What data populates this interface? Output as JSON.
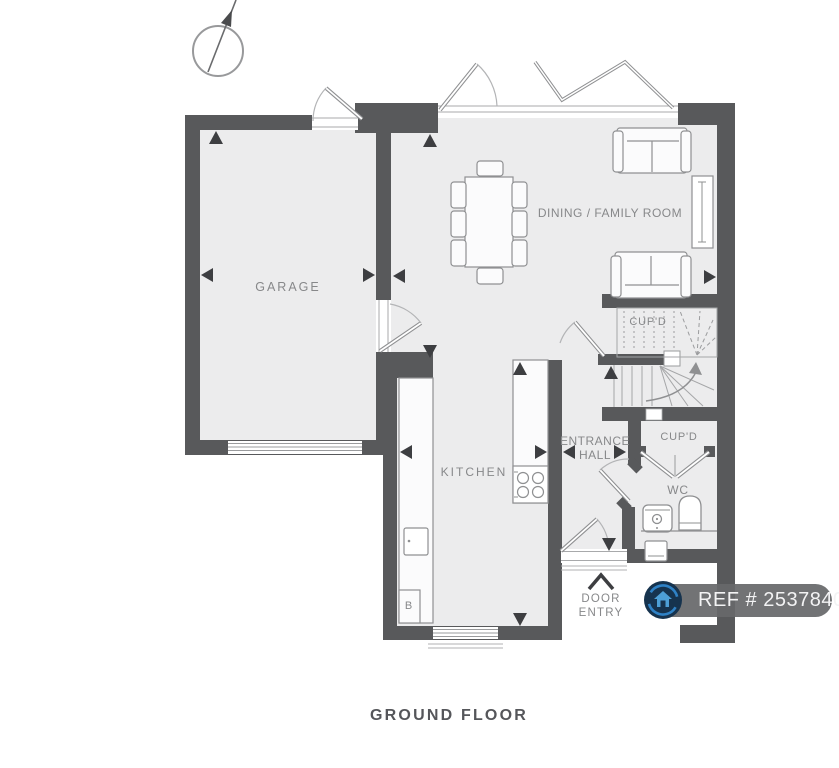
{
  "page": {
    "title": "GROUND FLOOR"
  },
  "rooms": {
    "garage": {
      "label": "GARAGE"
    },
    "dining_family_room": {
      "label": "DINING / FAMILY ROOM"
    },
    "kitchen": {
      "label": "KITCHEN"
    },
    "entrance_hall": {
      "label_line1": "ENTRANCE",
      "label_line2": "HALL"
    },
    "understairs_cupboard": {
      "label": "CUP'D"
    },
    "hall_cupboard": {
      "label": "CUP'D"
    },
    "wc": {
      "label": "WC"
    },
    "boiler": {
      "label": "B"
    }
  },
  "annotations": {
    "door_entry": {
      "line1": "DOOR",
      "line2": "ENTRY"
    }
  },
  "badge": {
    "ref_text": "REF # 2537840",
    "logo": "house-in-circle-icon"
  },
  "colors": {
    "wall": "#58595b",
    "floor": "#ececed",
    "line": "#8f9092",
    "label_text": "#87888a",
    "title_text": "#55565a",
    "badge_background": "#67686a",
    "badge_text": "#f3f3f4",
    "logo_ring_blue": "#2f82c6",
    "logo_navy": "#16334e"
  }
}
